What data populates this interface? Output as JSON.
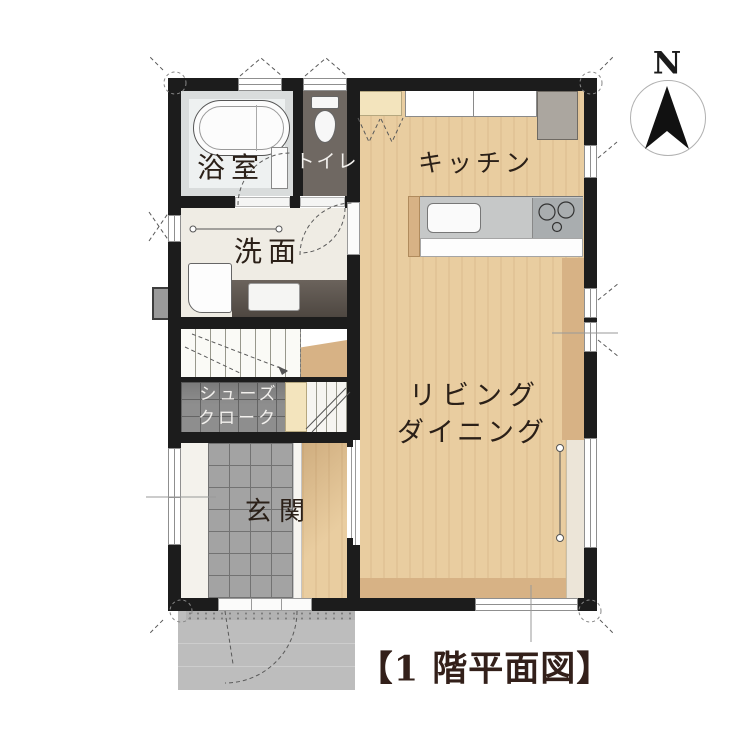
{
  "title": {
    "text": "【1 階平面図】"
  },
  "compass": {
    "label": "N"
  },
  "rooms": {
    "bathroom": {
      "label": "浴室"
    },
    "toilet": {
      "label": "トイレ"
    },
    "washroom": {
      "label": "洗面"
    },
    "kitchen": {
      "label": "キッチン"
    },
    "living": {
      "line1": "リビング",
      "line2": "ダイニング"
    },
    "shoe_closet": {
      "line1": "シューズ",
      "line2": "クローク"
    },
    "entrance": {
      "label": "玄関"
    }
  },
  "colors": {
    "wall": "#1c1c1c",
    "wood": "#e9cda0",
    "wood_dark": "#d7b285",
    "sill": "#ece5d8",
    "tile_genkan": "#a3a3a3",
    "tile_line": "#727272",
    "cloak": "#8e8e8e",
    "porch": "#bdbdbd",
    "porch_dot": "#7c7c7c",
    "toilet_floor": "#6f6862",
    "bath_floor": "#d9dcdc",
    "bath_inner": "#eef1f1",
    "wash_floor": "#efece4",
    "counter": "#c6c8c8",
    "stove": "#a9adaf",
    "fridge": "#aba69f",
    "cream": "#f3e4bd",
    "stairs": "#fafaf6",
    "vanity": "#5b534d",
    "label": "#2b2018",
    "label_light": "#f2f0ed",
    "title_color": "#33201a",
    "line": "#5a5a5a"
  }
}
